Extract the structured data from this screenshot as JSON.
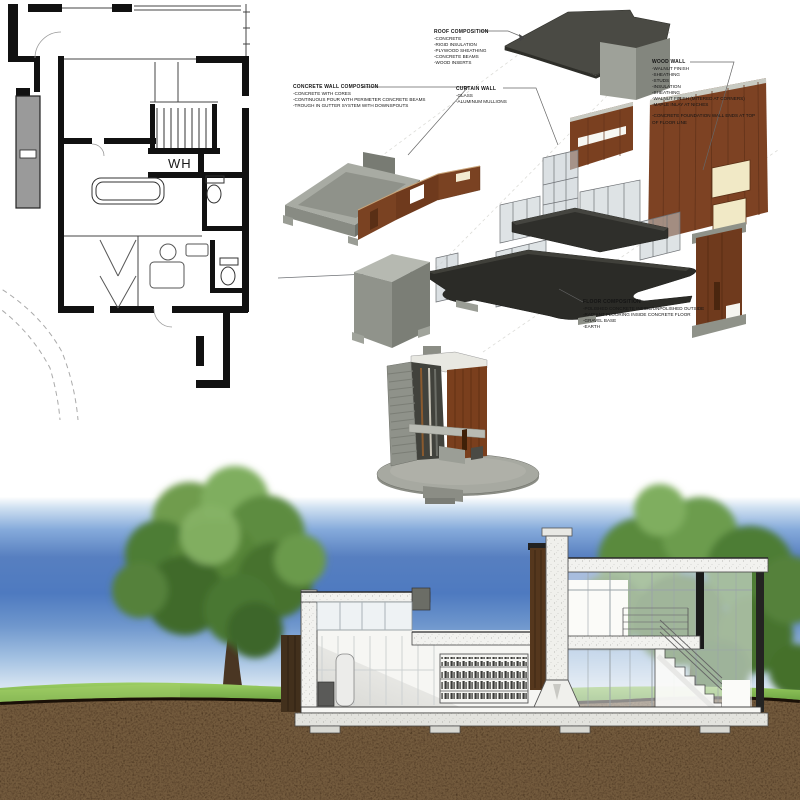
{
  "board": {
    "title": "Architectural presentation board",
    "background": "#ffffff"
  },
  "floor_plan": {
    "water_heater_label": "WH"
  },
  "annotations": {
    "roof": {
      "title": "ROOF COMPOSITION",
      "items": [
        "-CONCRETE",
        "-RIGID INSULATION",
        "-PLYWOOD SHEATHING",
        "-CONCRETE BEAMS",
        "-WOOD INSERTS"
      ]
    },
    "concrete_wall": {
      "title": "CONCRETE WALL COMPOSITION",
      "items": [
        "-CONCRETE WITH CORES",
        "-CONTINUOUS POUR WITH PERIMETER CONCRETE BEAMS",
        "-TROUGH IN GUTTER SYSTEM WITH DOWNSPOUTS"
      ]
    },
    "curtain_wall": {
      "title": "CURTAIN WALL",
      "items": [
        "-GLASS",
        "-ALUMINUM MULLIONS"
      ]
    },
    "wood_wall": {
      "title": "WOOD WALL",
      "items": [
        "-WALNUT FINISH",
        "-SHEATHING",
        "-STUDS",
        "-INSULATION",
        "-SHEATHING",
        "-WALNUT FINISH (MITERED AT CORNERS)",
        "-MAPLE INLAY AT NICHES",
        "",
        "-CONCRETE FOUNDATION WALL ENDS AT TOP OF FLOOR LINE"
      ]
    },
    "floor": {
      "title": "FLOOR COMPOSITION",
      "items": [
        "-POLISHED CONCRETE INSIDE/UNPOLISHED OUTSIDE",
        "-RADIANT FLOORING INSIDE CONCRETE FLOOR",
        "-GRAVEL BASE",
        "-EARTH"
      ]
    }
  },
  "colors": {
    "walnut": "#7a4021",
    "walnut_dark": "#5e2f12",
    "concrete": "#9a9d94",
    "roof_dark": "#45453f",
    "floor_plate_dark": "#2b2b27",
    "glass": "#b9c2c6",
    "window_cream": "#f1e9c6",
    "sky_deep": "#4d7ec6",
    "grass_green": "#5c9a38",
    "earth_brown": "#2e1d0e",
    "tree_green": "#4e7d36"
  }
}
